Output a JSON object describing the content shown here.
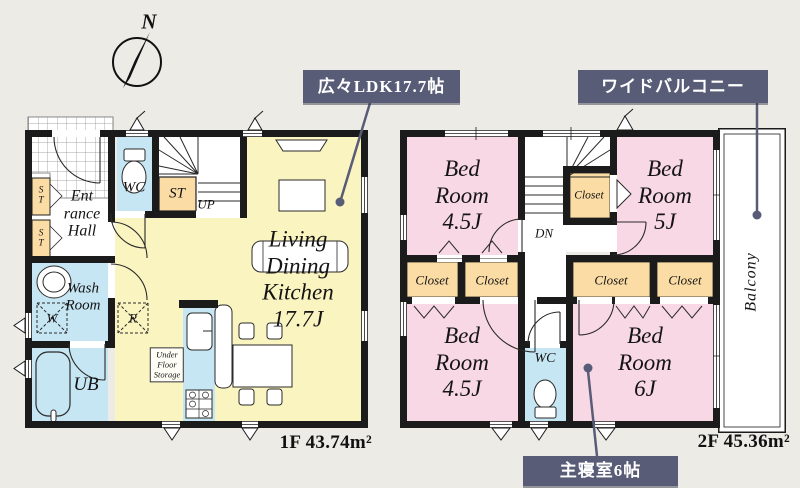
{
  "colors": {
    "background": "#edebe6",
    "wall": "#1b1b1b",
    "ldk_floor": "#faf4c0",
    "bedroom_floor": "#f8d8e4",
    "closet_fill": "#fbdca4",
    "wet_area_fill": "#c5e6f2",
    "callout_bg": "#585c77"
  },
  "compass": {
    "north": "N"
  },
  "callouts": {
    "ldk": "広々LDK17.7帖",
    "balcony": "ワイドバルコニー",
    "master": "主寝室6帖"
  },
  "floor1": {
    "area": "1F 43.74m²",
    "entrance_hall": "Ent\nrance\nHall",
    "wc": "WC",
    "st_left_upper": "ST",
    "st_left_lower": "ST",
    "st_stairs": "ST",
    "up": "UP",
    "ldk": "Living\nDining\nKitchen\n17.7J",
    "wash_room": "Wash\nRoom",
    "washer": "W",
    "fridge": "R",
    "bath": "UB",
    "under_floor_storage": "Under\nFloor\nStorage"
  },
  "floor2": {
    "area": "2F 45.36m²",
    "bedroom_nw": "Bed\nRoom\n4.5J",
    "bedroom_ne": "Bed\nRoom\n5J",
    "bedroom_sw": "Bed\nRoom\n4.5J",
    "bedroom_se": "Bed\nRoom\n6J",
    "closet_stair": "Closet",
    "closets": [
      "Closet",
      "Closet",
      "Closet",
      "Closet"
    ],
    "wc": "WC",
    "dn": "DN",
    "balcony": "Balcony"
  }
}
